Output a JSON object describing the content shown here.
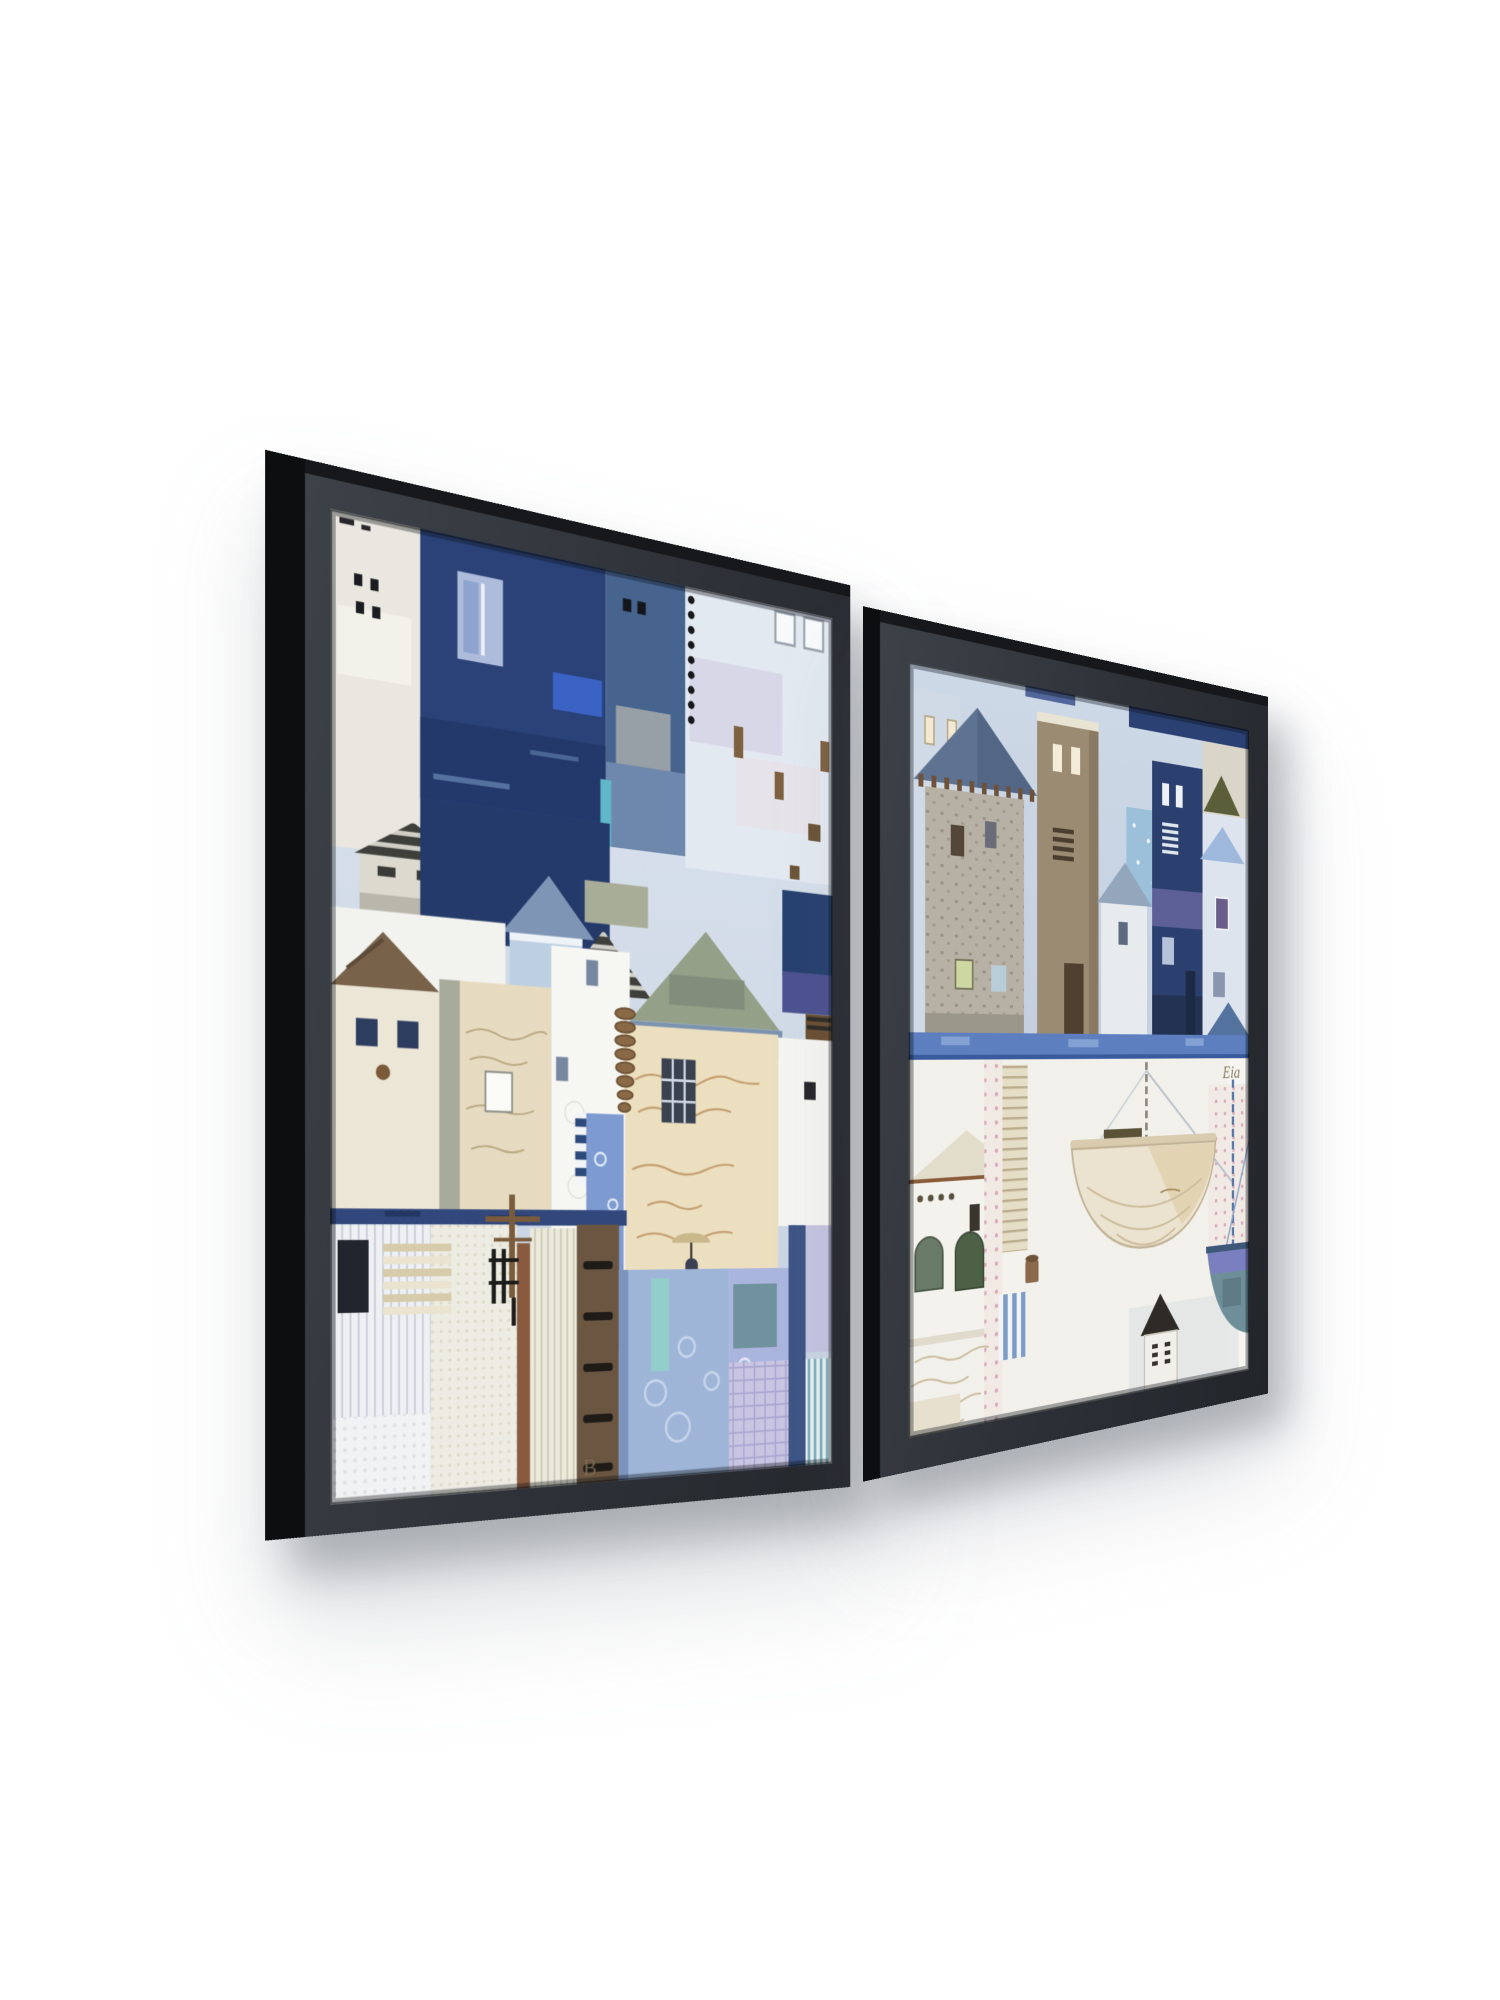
{
  "scene": {
    "background_color": "#ffffff",
    "description": "Product photo of a two-piece black floating-frame wall art set on a white wall, photographed at an angle from the left, soft shadows below and right of each frame",
    "shadow_color": "rgba(96,102,112,0.40)"
  },
  "frames": {
    "left": {
      "alt": "Large black floating frame: abstract coastal town collage with tall navy and steel-blue houses over white, cream and patterned patchwork cottages, striped roofs, a script-paper tower, telegraph cross and denim-blue floral patches",
      "frame_color": "#2f343a",
      "edge_color": "#0c0e10",
      "art_text_fragment": "B",
      "palette": {
        "navy": "#2b4278",
        "steel": "#47648f",
        "sky": "#cfd9e5",
        "cream": "#e6dbc1",
        "white": "#f2f2ee",
        "denim": "#9fb5d8",
        "brown": "#6b5741",
        "lavender": "#aab5de"
      }
    },
    "right": {
      "alt": "Smaller black floating frame: harbour collage with a windmill tower, tan and navy houses above a torn blue ribbon, and a white quay with a hanging cream boat hull, blue bowl, striped awning and a tiny black-roofed hut",
      "frame_color": "#2f343a",
      "edge_color": "#0c0e10",
      "art_text_fragment": "Eia",
      "palette": {
        "navy": "#2c4070",
        "tan": "#9c8b73",
        "sky": "#c3cfdf",
        "ribbon": "#5d7fc0",
        "hull": "#ebe3d0",
        "bowl": "#5878ab",
        "olive": "#5a5e39"
      }
    }
  }
}
